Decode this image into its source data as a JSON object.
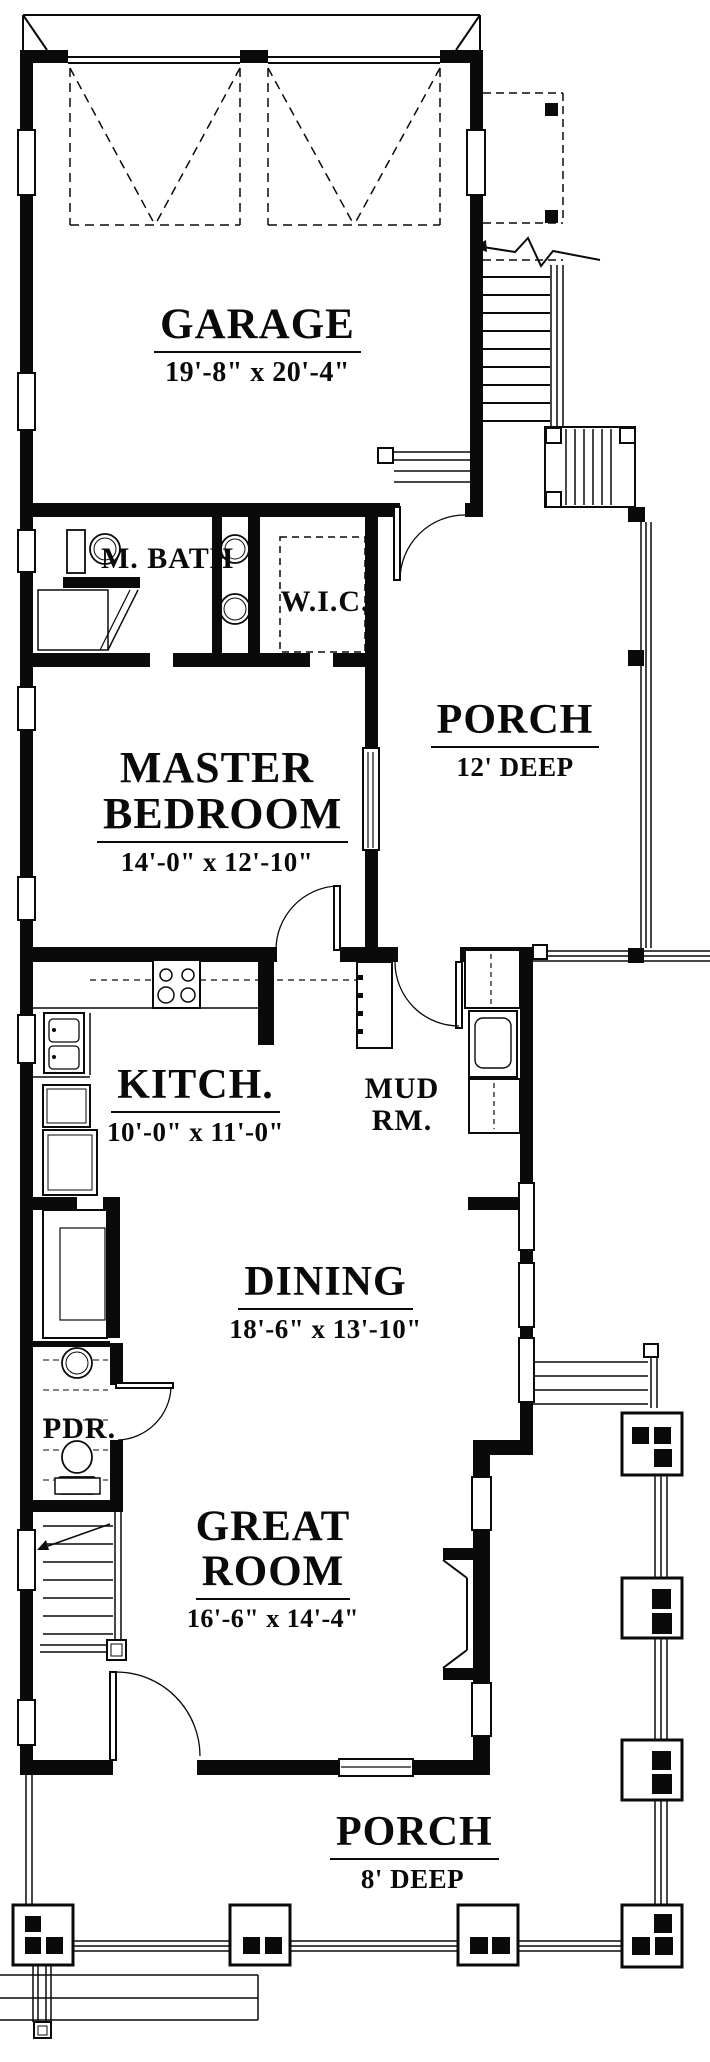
{
  "rooms": {
    "garage": {
      "name": "GARAGE",
      "dim": "19'-8\" x 20'-4\""
    },
    "master_bath": {
      "name": "M. BATH"
    },
    "wic": {
      "name": "W.I.C."
    },
    "porch_side": {
      "name": "PORCH",
      "dim": "12' DEEP"
    },
    "master_bedroom": {
      "line1": "MASTER",
      "line2": "BEDROOM",
      "dim": "14'-0\" x 12'-10\""
    },
    "kitchen": {
      "name": "KITCH.",
      "dim": "10'-0\" x 11'-0\""
    },
    "mud_room": {
      "name": "MUD RM."
    },
    "dining": {
      "name": "DINING",
      "dim": "18'-6\" x 13'-10\""
    },
    "powder": {
      "name": "PDR."
    },
    "great_room": {
      "line1": "GREAT",
      "line2": "ROOM",
      "dim": "16'-6\" x 14'-4\""
    },
    "porch_front": {
      "name": "PORCH",
      "dim": "8' DEEP"
    }
  },
  "colors": {
    "ink": "#0a0a0a",
    "paper": "#ffffff"
  }
}
